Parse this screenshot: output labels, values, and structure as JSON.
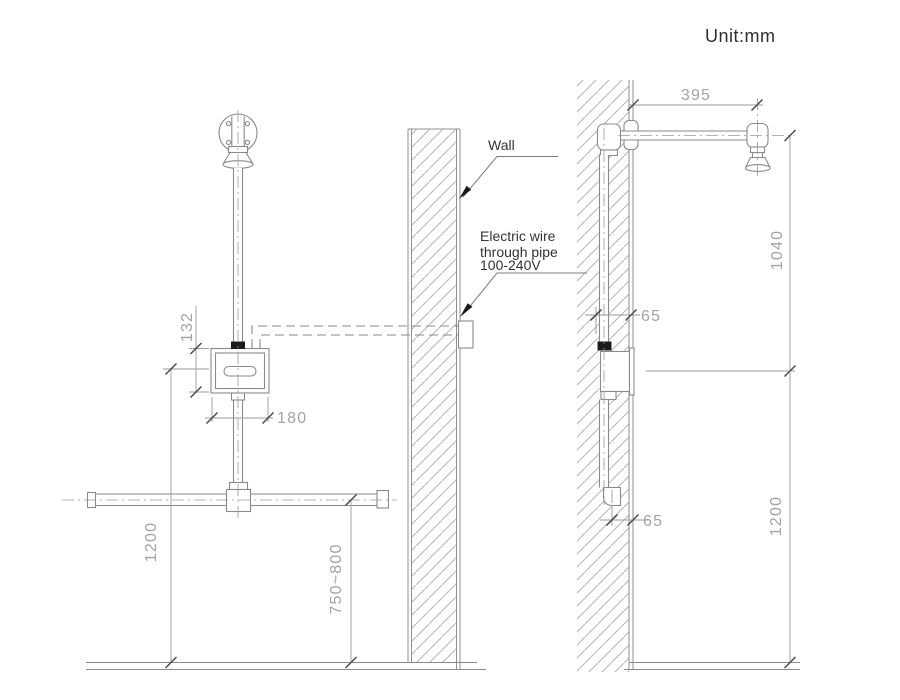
{
  "unit_label": "Unit:mm",
  "labels": {
    "wall": "Wall",
    "electric_wire": [
      "Electric wire",
      "through pipe",
      "100-240V"
    ]
  },
  "front_view": {
    "sensor_height": "132",
    "sensor_width": "180",
    "sensor_to_floor": "1200",
    "supply_to_floor": "750~800"
  },
  "side_view": {
    "arm_length": "395",
    "head_drop": "1040",
    "offset_top": "65",
    "offset_bottom": "65",
    "supply_to_floor": "1200"
  },
  "colors": {
    "line": "#8a8a8a",
    "hatch": "#b4b4b4",
    "dim_text": "#a3a3a3",
    "label_text": "#333333"
  }
}
